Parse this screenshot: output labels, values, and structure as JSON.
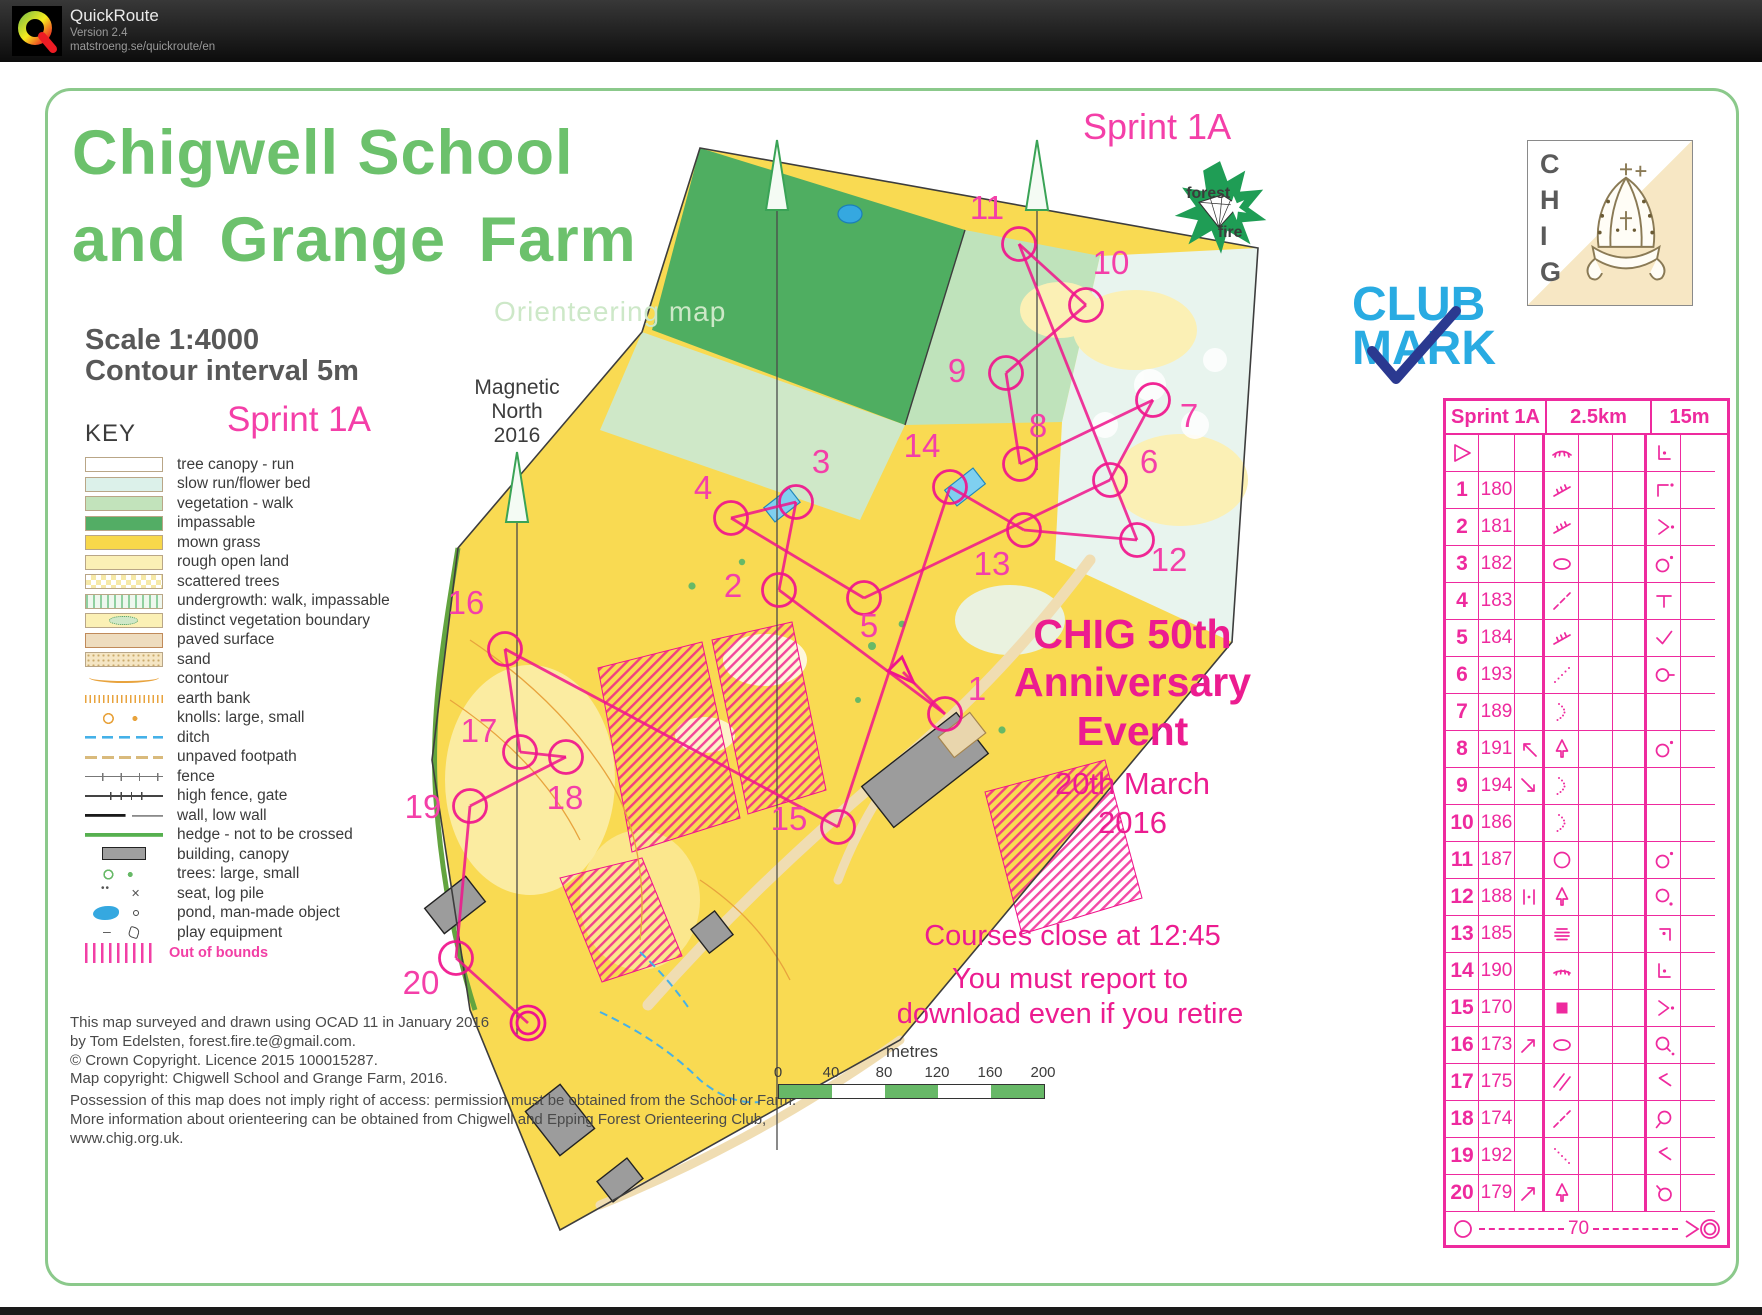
{
  "app": {
    "name": "QuickRoute",
    "version": "Version 2.4",
    "url": "matstroeng.se/quickroute/en"
  },
  "map": {
    "title_line1": "Chigwell School",
    "title_line2": "and Grange Farm",
    "subtitle": "Orienteering map",
    "scale": "Scale  1:4000",
    "contour": "Contour interval  5m",
    "course_label_left": "Sprint 1A",
    "course_label_top": "Sprint 1A",
    "magnetic_north": [
      "Magnetic",
      "North",
      "2016"
    ]
  },
  "key": {
    "heading": "KEY",
    "items": [
      {
        "label": "tree canopy - run",
        "swatch": "canopy"
      },
      {
        "label": "slow run/flower bed",
        "swatch": "slowrun"
      },
      {
        "label": "vegetation - walk",
        "swatch": "vegwalk"
      },
      {
        "label": "impassable",
        "swatch": "impassable"
      },
      {
        "label": "mown grass",
        "swatch": "mown"
      },
      {
        "label": "rough open land",
        "swatch": "rough"
      },
      {
        "label": "scattered trees",
        "swatch": "scattered"
      },
      {
        "label": "undergrowth: walk, impassable",
        "swatch": "undergrowth"
      },
      {
        "label": "distinct vegetation boundary",
        "swatch": "distinctveg"
      },
      {
        "label": "paved surface",
        "swatch": "paved"
      },
      {
        "label": "sand",
        "swatch": "sand"
      },
      {
        "label": "contour",
        "swatch": "contour"
      },
      {
        "label": "earth bank",
        "swatch": "earthbank"
      },
      {
        "label": "knolls: large, small",
        "swatch": "knolls"
      },
      {
        "label": "ditch",
        "swatch": "ditch"
      },
      {
        "label": "unpaved footpath",
        "swatch": "footpath"
      },
      {
        "label": "fence",
        "swatch": "fence"
      },
      {
        "label": "high fence, gate",
        "swatch": "highfence"
      },
      {
        "label": "wall, low wall",
        "swatch": "wall"
      },
      {
        "label": "hedge - not to be crossed",
        "swatch": "hedge"
      },
      {
        "label": "building, canopy",
        "swatch": "building"
      },
      {
        "label": "trees: large, small",
        "swatch": "trees"
      },
      {
        "label": "seat, log pile",
        "swatch": "seat"
      },
      {
        "label": "pond, man-made object",
        "swatch": "pond"
      },
      {
        "label": "play equipment",
        "swatch": "play"
      }
    ],
    "out_of_bounds": "Out of bounds"
  },
  "event": {
    "title_lines": [
      "CHIG 50th",
      "Anniversary",
      "Event"
    ],
    "date_lines": [
      "20th March",
      "2016"
    ],
    "notice1": "Courses close at 12:45",
    "notice2_lines": [
      "You must report to",
      "download even if you retire"
    ]
  },
  "scalebar": {
    "unit": "metres",
    "ticks": [
      "0",
      "40",
      "80",
      "120",
      "160",
      "200"
    ]
  },
  "credits": {
    "block1": [
      "This map surveyed and drawn using OCAD 11 in January 2016",
      "by Tom Edelsten, forest.fire.te@gmail.com.",
      "© Crown Copyright. Licence 2015 100015287.",
      "Map copyright: Chigwell School and Grange Farm, 2016."
    ],
    "block2": [
      "Possession of this map does not imply right of access: permission must be obtained from the School or Farm.",
      "More information about orienteering can be obtained from Chigwell and Epping Forest Orienteering Club,",
      "www.chig.org.uk."
    ]
  },
  "logos": {
    "forest_fire": {
      "word1": "forest",
      "word2": "fire"
    },
    "chig": {
      "letters": [
        "C",
        "H",
        "I",
        "G"
      ]
    },
    "clubmark": {
      "line1": "CLUB",
      "line2": "MARK"
    }
  },
  "descriptions": {
    "header": {
      "course": "Sprint 1A",
      "length": "2.5km",
      "climb": "15m"
    },
    "rows": [
      {
        "a": "start",
        "b": "",
        "c": "",
        "d": "veg-boundary",
        "g": "corner-l-dot"
      },
      {
        "a": "1",
        "b": "180",
        "c": "",
        "d": "earth-bank",
        "g": "corner-nw-dot"
      },
      {
        "a": "2",
        "b": "181",
        "c": "",
        "d": "earth-bank",
        "g": "chevron-e-dot"
      },
      {
        "a": "3",
        "b": "182",
        "c": "",
        "d": "oval",
        "g": "circle-dot-ne"
      },
      {
        "a": "4",
        "b": "183",
        "c": "",
        "d": "dashed-line",
        "g": "tee"
      },
      {
        "a": "5",
        "b": "184",
        "c": "",
        "d": "earth-bank",
        "g": "bend-check"
      },
      {
        "a": "6",
        "b": "193",
        "c": "",
        "d": "dotted-diag-ne",
        "g": "circle-dash-e"
      },
      {
        "a": "7",
        "b": "189",
        "c": "",
        "d": "dotted-curve",
        "g": ""
      },
      {
        "a": "8",
        "b": "191",
        "c": "arrow-nw",
        "d": "tree",
        "g": "circle-dot-ne"
      },
      {
        "a": "9",
        "b": "194",
        "c": "arrow-se",
        "d": "dotted-curve",
        "g": ""
      },
      {
        "a": "10",
        "b": "186",
        "c": "",
        "d": "dotted-curve",
        "g": ""
      },
      {
        "a": "11",
        "b": "187",
        "c": "",
        "d": "circle",
        "g": "circle-dot-ne"
      },
      {
        "a": "12",
        "b": "188",
        "c": "between",
        "d": "tree",
        "g": "circle-dot-se"
      },
      {
        "a": "13",
        "b": "185",
        "c": "",
        "d": "steps",
        "g": "corner-ne-dot"
      },
      {
        "a": "14",
        "b": "190",
        "c": "",
        "d": "eyelash",
        "g": "corner-l-dot"
      },
      {
        "a": "15",
        "b": "170",
        "c": "",
        "d": "filled-square",
        "g": "chevron-e-dot"
      },
      {
        "a": "16",
        "b": "173",
        "c": "arrow-ne",
        "d": "oval",
        "g": "circle-tail-dot-se"
      },
      {
        "a": "17",
        "b": "175",
        "c": "",
        "d": "crossing",
        "g": "bend-nw"
      },
      {
        "a": "18",
        "b": "174",
        "c": "",
        "d": "dashed-line",
        "g": "circle-tail-sw"
      },
      {
        "a": "19",
        "b": "192",
        "c": "",
        "d": "dotted-diag-se",
        "g": "bend-nw"
      },
      {
        "a": "20",
        "b": "179",
        "c": "arrow-ne",
        "d": "tree",
        "g": "circle-tail-nw"
      }
    ],
    "finish": {
      "distance": "70"
    }
  },
  "course": {
    "start": {
      "x": 903,
      "y": 672
    },
    "finish": {
      "x": 528,
      "y": 1023
    },
    "controls": [
      {
        "n": "1",
        "cx": 945,
        "cy": 714,
        "lx": 977,
        "ly": 700
      },
      {
        "n": "2",
        "cx": 779,
        "cy": 590,
        "lx": 733,
        "ly": 597
      },
      {
        "n": "3",
        "cx": 796,
        "cy": 502,
        "lx": 821,
        "ly": 473
      },
      {
        "n": "4",
        "cx": 731,
        "cy": 518,
        "lx": 703,
        "ly": 499
      },
      {
        "n": "5",
        "cx": 864,
        "cy": 598,
        "lx": 869,
        "ly": 637
      },
      {
        "n": "6",
        "cx": 1110,
        "cy": 480,
        "lx": 1149,
        "ly": 473
      },
      {
        "n": "7",
        "cx": 1153,
        "cy": 400,
        "lx": 1189,
        "ly": 427
      },
      {
        "n": "8",
        "cx": 1020,
        "cy": 464,
        "lx": 1038,
        "ly": 437
      },
      {
        "n": "9",
        "cx": 1006,
        "cy": 373,
        "lx": 957,
        "ly": 382
      },
      {
        "n": "10",
        "cx": 1086,
        "cy": 305,
        "lx": 1111,
        "ly": 274
      },
      {
        "n": "11",
        "cx": 1019,
        "cy": 244,
        "lx": 987,
        "ly": 219
      },
      {
        "n": "12",
        "cx": 1137,
        "cy": 540,
        "lx": 1169,
        "ly": 571
      },
      {
        "n": "13",
        "cx": 1024,
        "cy": 530,
        "lx": 992,
        "ly": 575
      },
      {
        "n": "14",
        "cx": 950,
        "cy": 487,
        "lx": 922,
        "ly": 457
      },
      {
        "n": "15",
        "cx": 838,
        "cy": 827,
        "lx": 789,
        "ly": 830
      },
      {
        "n": "16",
        "cx": 505,
        "cy": 649,
        "lx": 466,
        "ly": 614
      },
      {
        "n": "17",
        "cx": 520,
        "cy": 752,
        "lx": 479,
        "ly": 742
      },
      {
        "n": "18",
        "cx": 566,
        "cy": 757,
        "lx": 565,
        "ly": 809
      },
      {
        "n": "19",
        "cx": 470,
        "cy": 806,
        "lx": 423,
        "ly": 818
      },
      {
        "n": "20",
        "cx": 456,
        "cy": 958,
        "lx": 421,
        "ly": 994
      }
    ]
  }
}
